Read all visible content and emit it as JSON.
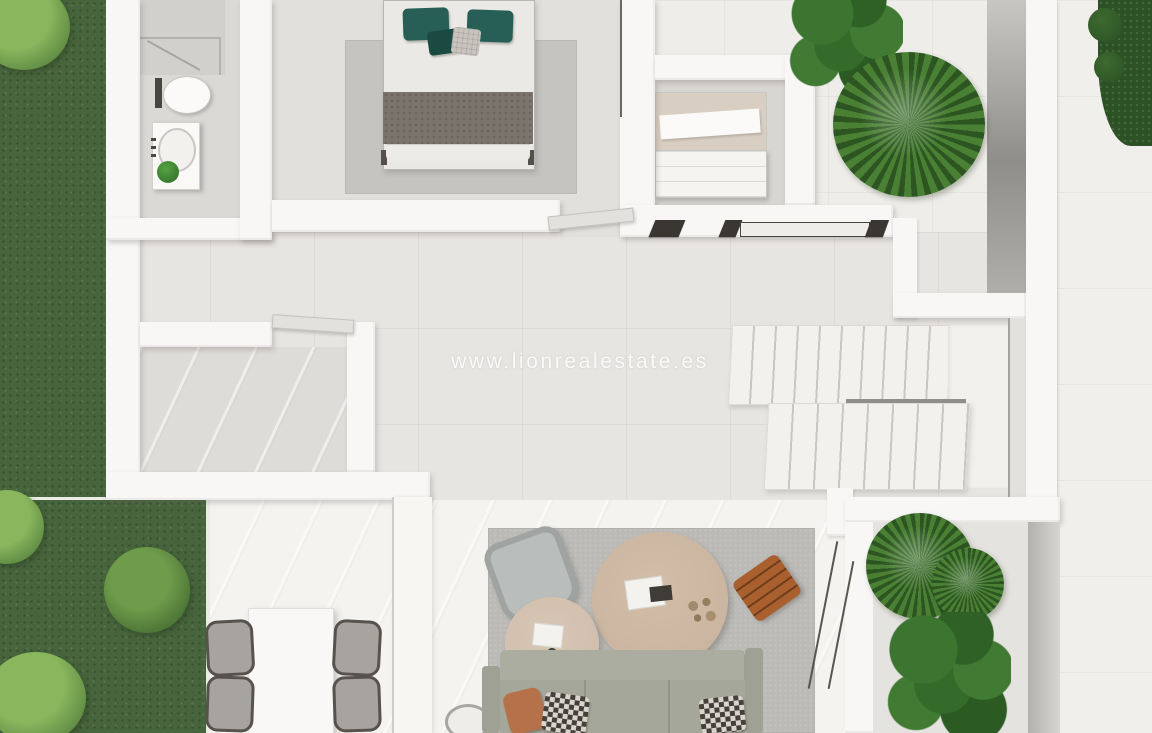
{
  "watermark": {
    "text": "www.lionrealestate.es"
  },
  "palette": {
    "grass": "#47653c",
    "bush_light": "#8ab65e",
    "bush_mid": "#5e8b42",
    "hedge": "#2c5125",
    "plant": "#4a8034",
    "wall": "#f8f7f5",
    "wall_edge": "#c7c5c2",
    "floor_patio": "#eeede9",
    "floor_bright": "#f4f3f0",
    "floor_hall": "#e7e5e2",
    "floor_bath": "#dbd9d6",
    "floor_bedroom": "#e2e0dd",
    "floor_room": "#dedcd8",
    "rug_bedroom": "#c6c4c1",
    "rug_living": "#bcbab6",
    "bed_linen": "#ebe9e5",
    "pillow_teal": "#275f57",
    "pillow_teal_dark": "#1a4a41",
    "pillow_knit": "#c9c5be",
    "blanket": "#7c746c",
    "sofa_back": "#abada0",
    "sofa_seat": "#a5a79a",
    "pillow_terracotta": "#b5714a",
    "pillow_checker_dark": "#45403a",
    "pillow_checker_light": "#d9d4cd",
    "table_round_large": "#c8b29e",
    "table_round_small": "#cfbcab",
    "stool_wood": "#a95f2e",
    "chair_cushion": "#a7a4a0",
    "chair_frame": "#57524b",
    "gray_wall": "#a5a3a0",
    "watermark": "rgba(255,255,255,0.88)"
  }
}
